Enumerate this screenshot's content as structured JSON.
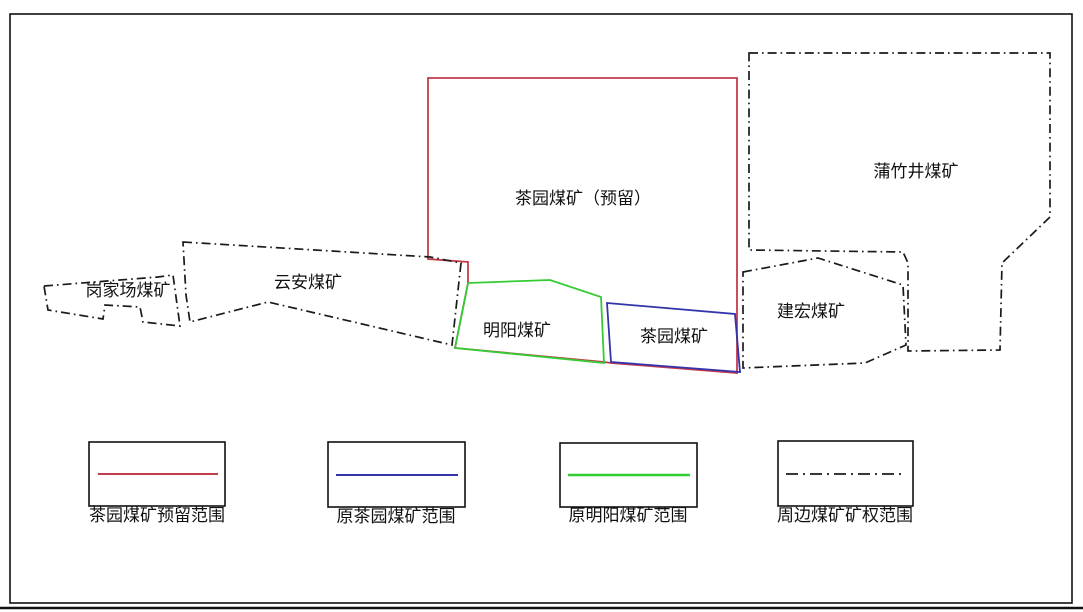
{
  "map": {
    "regions": [
      {
        "name": "gangjiachang",
        "label": "岗家场煤矿",
        "boundary_style": "dash-dot-black"
      },
      {
        "name": "yunan",
        "label": "云安煤矿",
        "boundary_style": "dash-dot-black"
      },
      {
        "name": "chayuan_reserved",
        "label": "茶园煤矿（预留）",
        "boundary_style": "solid-red"
      },
      {
        "name": "mingyang",
        "label": "明阳煤矿",
        "boundary_style": "solid-green"
      },
      {
        "name": "chayuan_original",
        "label": "茶园煤矿",
        "boundary_style": "solid-blue"
      },
      {
        "name": "jianhong",
        "label": "建宏煤矿",
        "boundary_style": "dash-dot-black"
      },
      {
        "name": "puzhujing",
        "label": "蒲竹井煤矿",
        "boundary_style": "dash-dot-black"
      }
    ]
  },
  "legend": {
    "items": [
      {
        "label": "茶园煤矿预留范围",
        "line": "solid",
        "color": "#c43c4c"
      },
      {
        "label": "原茶园煤矿范围",
        "line": "solid",
        "color": "#3333aa"
      },
      {
        "label": "原明阳煤矿范围",
        "line": "solid",
        "color": "#33cc33"
      },
      {
        "label": "周边煤矿矿权范围",
        "line": "dash-dot",
        "color": "#1a1a1a"
      }
    ]
  },
  "colors": {
    "reserved_boundary": "#c43c4c",
    "original_chayuan_boundary": "#3333aa",
    "original_mingyang_boundary": "#33cc33",
    "surrounding_boundary": "#1a1a1a",
    "frame": "#111111"
  }
}
